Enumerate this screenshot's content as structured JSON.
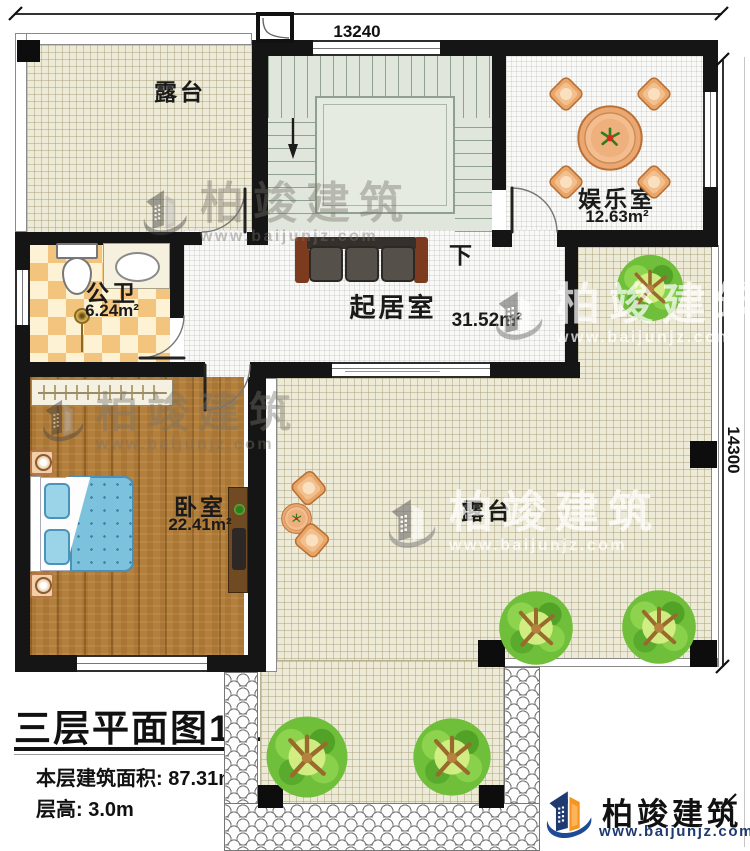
{
  "dimensions": {
    "top": "13240",
    "right": "14300"
  },
  "rooms": {
    "terrace_top": {
      "name": "露台"
    },
    "entertainment": {
      "name": "娱乐室",
      "area": "12.63m²"
    },
    "bathroom": {
      "name": "公卫",
      "area": "6.24m²"
    },
    "living": {
      "name": "起居室",
      "area": "31.52m²"
    },
    "bedroom": {
      "name": "卧室",
      "area": "22.41m²"
    },
    "terrace_main": {
      "name": "露台"
    },
    "stair_down_label": "下"
  },
  "title_block": {
    "title": "三层平面图",
    "scale": "1:100",
    "area_line": "本层建筑面积: 87.31m²",
    "height_line": "层高: 3.0m"
  },
  "brand": {
    "name": "柏竣建筑",
    "site": "www.baijunjz.com"
  },
  "watermark": {
    "name": "柏竣建筑",
    "site": "www.baijunjz.com"
  },
  "colors": {
    "wall": "#151515",
    "terrace_floor": "#edead8",
    "wood_floor": "#b37f3c",
    "stair_floor": "#e0e6db",
    "brand_blue": "#1e4b96",
    "brand_orange": "#f7941d"
  }
}
